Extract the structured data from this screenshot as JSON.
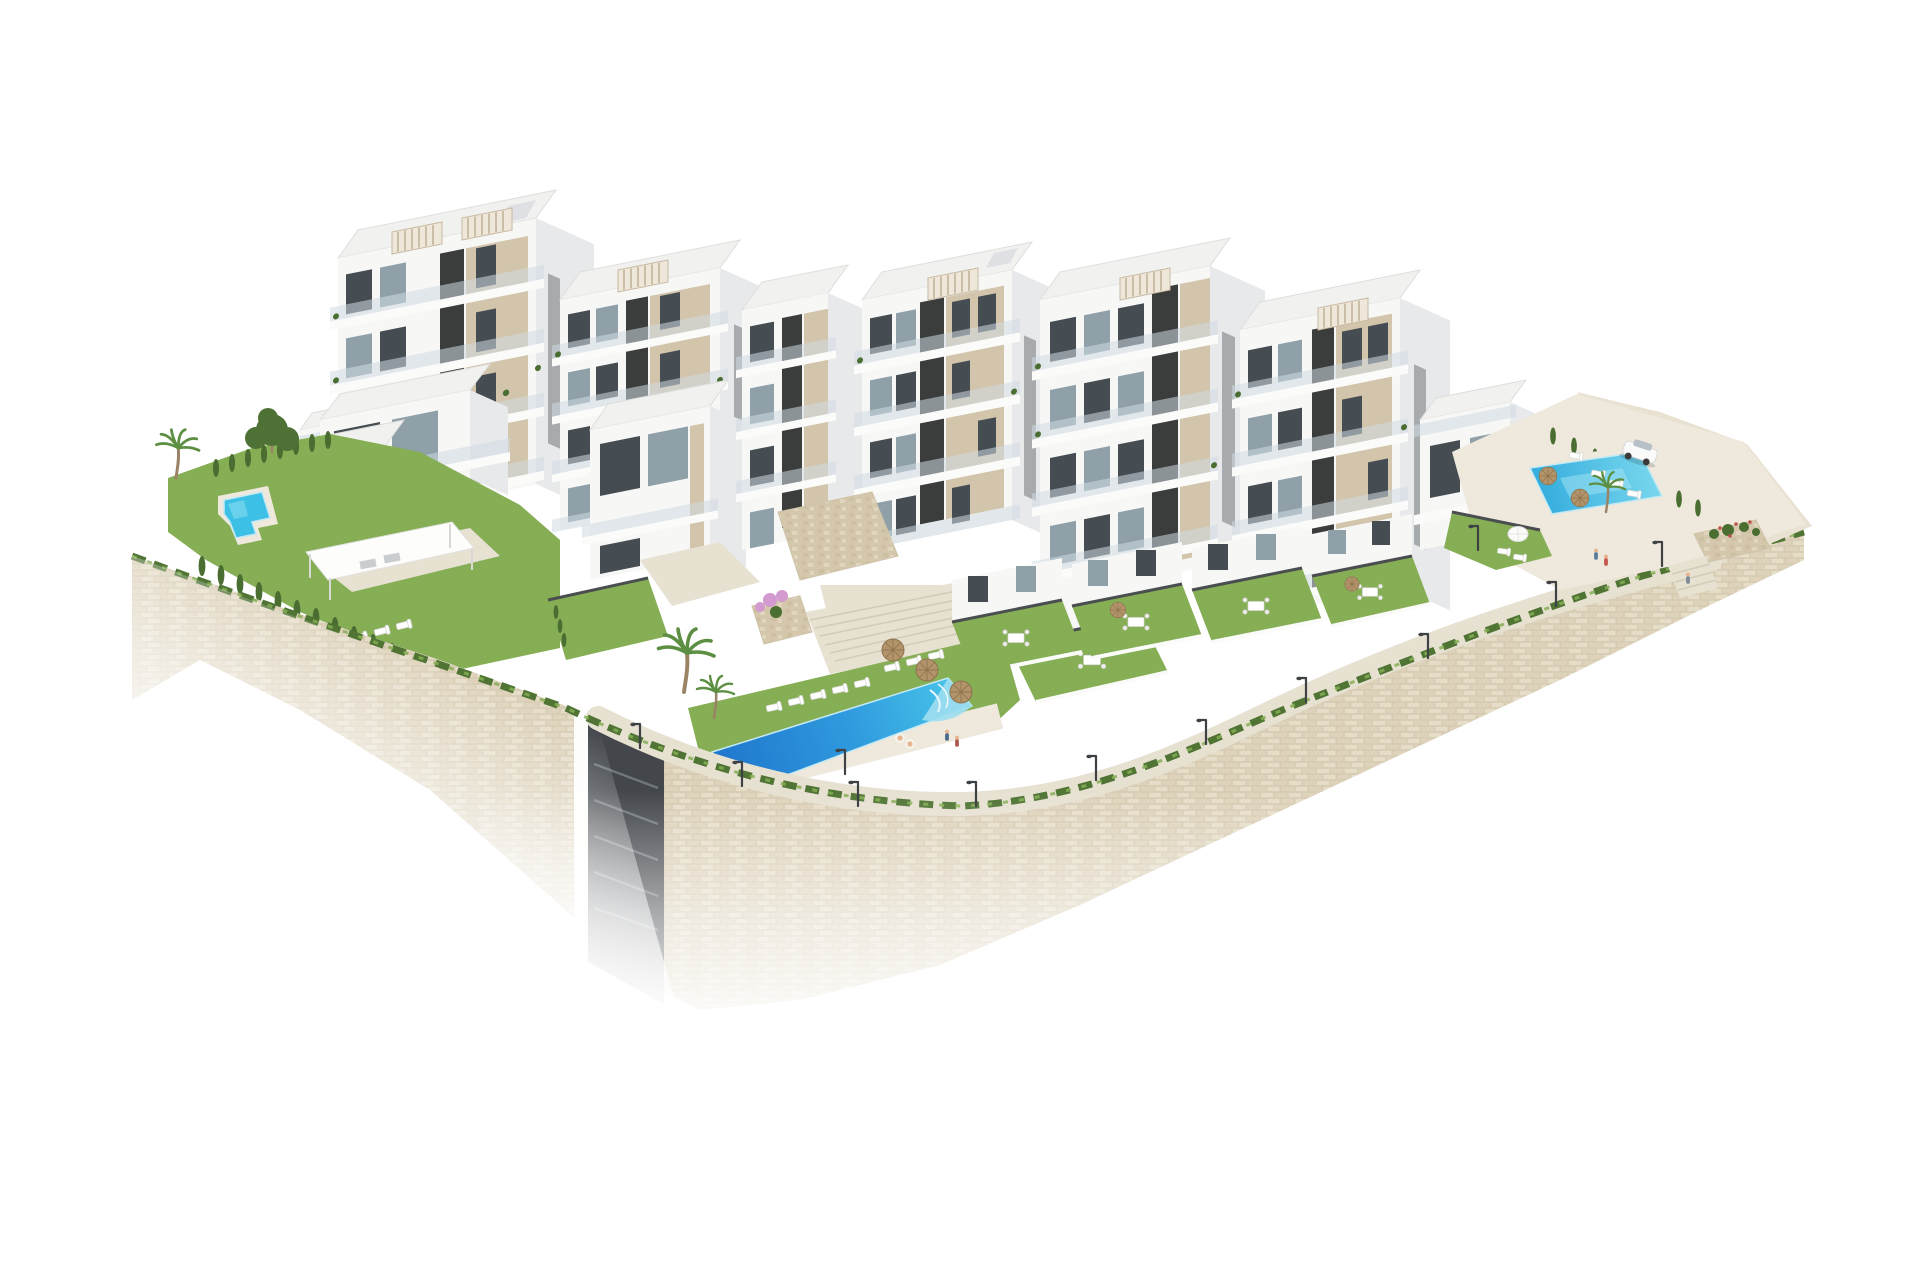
{
  "palette": {
    "bg": "#ffffff",
    "faceWhite": "#f7f7f6",
    "faceWhite2": "#fdfdfc",
    "faceShade": "#e8e9eb",
    "faceShade2": "#dfe0e3",
    "roof": "#f1f1ef",
    "roofEdge": "#dededc",
    "beige": "#d3c5ac",
    "beigeShade": "#c3b49a",
    "dark": "#3a3d3c",
    "window": "#454d52",
    "windowLight": "#8fa0a8",
    "glass": "#cfdbe1",
    "slab": "#fbfbfa",
    "pergFill": "#efe8da",
    "pergLine": "#c6b9a1",
    "grass": "#85ae55",
    "grassDark": "#6d9440",
    "hedge": "#4a6e31",
    "pine": "#4e7136",
    "shrub": "#4f7434",
    "palm": "#5d8f43",
    "trunk": "#9a8465",
    "paving": "#e7e1d2",
    "pavingLight": "#eee9dc",
    "rock": "#e9e2d2",
    "stoneBase": "#e8e0cd",
    "stone1": "#e6ddc8",
    "stone2": "#ded3ba",
    "stoneLine": "#cfc3a9",
    "mosaic1": "#cdbfa2",
    "mosaic2": "#e0d6c0",
    "mosaic3": "#d4c7ac",
    "poolDeep": "#1f74cc",
    "poolMid": "#2f9ade",
    "poolLight": "#49c6ea",
    "poolPale": "#9fdef0",
    "straw": "#b3946a",
    "strawDark": "#8f7450",
    "fence": "#4b4e50",
    "metal": "#3f4244",
    "stepLine": "#d2cbb8",
    "skin": "#e8b48e",
    "blossom": "#d39ad0",
    "flowerRed": "#c0504a",
    "carBody": "#fafafa",
    "carGlass": "#b6c0c6"
  },
  "scene": {
    "type": "aerial-architectural-render",
    "background": "white",
    "elements": [
      {
        "name": "apartment-blocks",
        "count": 9,
        "style": "white-modern-with-beige-panels"
      },
      {
        "name": "rooftop-pergolas",
        "count": 6
      },
      {
        "name": "community-pool-central",
        "count": 1
      },
      {
        "name": "community-pool-right",
        "count": 1
      },
      {
        "name": "private-pool-left-garden",
        "count": 1
      },
      {
        "name": "lawn-terraces",
        "count": 7
      },
      {
        "name": "dining-sets",
        "count": 5
      },
      {
        "name": "sun-loungers",
        "count": 20
      },
      {
        "name": "straw-parasols",
        "count": 5
      },
      {
        "name": "white-parasols",
        "count": 2
      },
      {
        "name": "palm-trees",
        "count": 5
      },
      {
        "name": "cypress-hedges",
        "count": 3
      },
      {
        "name": "pine-tree",
        "count": 1
      },
      {
        "name": "stone-retaining-wall",
        "count": 1
      },
      {
        "name": "central-staircase",
        "count": 1
      },
      {
        "name": "service-stairwell",
        "count": 1
      },
      {
        "name": "street-lamps",
        "count": 12
      },
      {
        "name": "white-suv-car",
        "count": 1
      },
      {
        "name": "pedestrians",
        "count": 5
      },
      {
        "name": "swimmers",
        "count": 2
      }
    ]
  }
}
